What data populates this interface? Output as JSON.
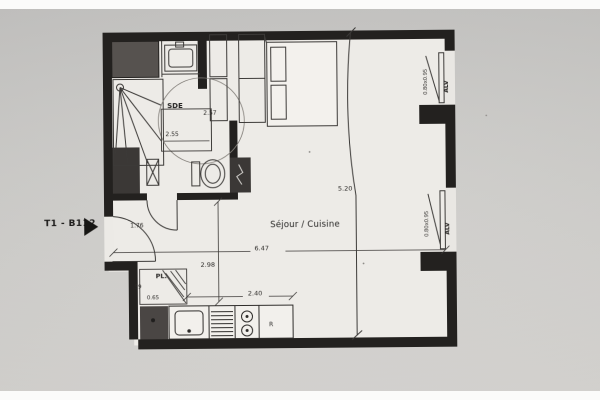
{
  "unit_label": "T1 - B112",
  "labels": {
    "sde": "SDE",
    "sejour_cuisine": "Séjour / Cuisine",
    "closet": "PL.",
    "fridge": "R",
    "window": "ALV",
    "window_size": "0.80x0.95"
  },
  "dimensions": {
    "sde_width": "2.55",
    "sde_height": "2.57",
    "living_width": "6.47",
    "living_height": "5.20",
    "entry_height": "2.98",
    "kitchen_length": "2.40",
    "entry_door": "1.76",
    "closet_depth": ".59",
    "closet_width": "0.65"
  },
  "colors": {
    "walls": "#23211f",
    "photo_background": "#cdccc9",
    "floor": "#edebe7",
    "linework": "#3c3a38"
  }
}
